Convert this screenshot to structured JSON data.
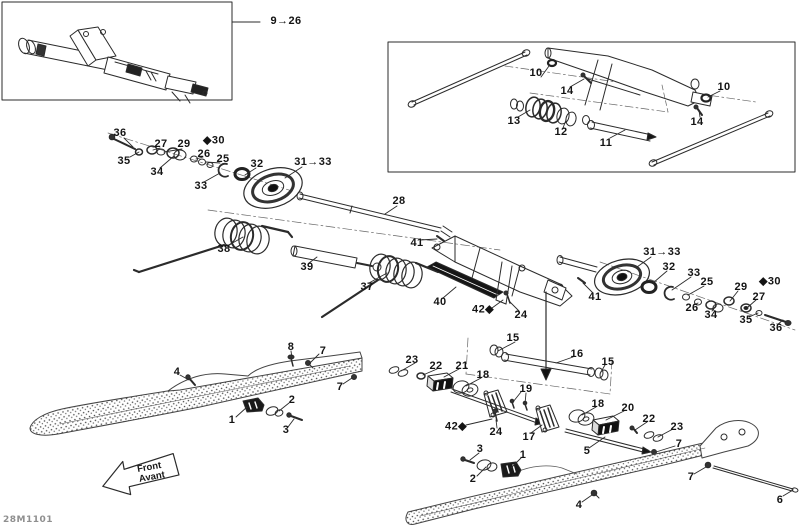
{
  "doc": {
    "part_code": "28M1101"
  },
  "front_arrow": {
    "line1": "Front",
    "line2": "Avant"
  },
  "colors": {
    "line": "#2b2b2b",
    "label": "#141414",
    "muted": "#8f8f8f",
    "dark_fill": "#161616"
  },
  "callouts": [
    {
      "t": "9→26",
      "x": 286,
      "y": 21
    },
    {
      "t": "10",
      "x": 536,
      "y": 73
    },
    {
      "t": "14",
      "x": 567,
      "y": 91
    },
    {
      "t": "13",
      "x": 514,
      "y": 121
    },
    {
      "t": "12",
      "x": 561,
      "y": 132
    },
    {
      "t": "11",
      "x": 606,
      "y": 143
    },
    {
      "t": "10",
      "x": 724,
      "y": 87
    },
    {
      "t": "14",
      "x": 697,
      "y": 122
    },
    {
      "t": "36",
      "x": 120,
      "y": 133
    },
    {
      "t": "35",
      "x": 124,
      "y": 161
    },
    {
      "t": "27",
      "x": 161,
      "y": 144
    },
    {
      "t": "29",
      "x": 184,
      "y": 144
    },
    {
      "t": "◆30",
      "x": 214,
      "y": 140
    },
    {
      "t": "34",
      "x": 157,
      "y": 172
    },
    {
      "t": "26",
      "x": 204,
      "y": 154
    },
    {
      "t": "25",
      "x": 223,
      "y": 159
    },
    {
      "t": "33",
      "x": 201,
      "y": 186
    },
    {
      "t": "32",
      "x": 257,
      "y": 164
    },
    {
      "t": "31→33",
      "x": 313,
      "y": 162
    },
    {
      "t": "28",
      "x": 399,
      "y": 201
    },
    {
      "t": "38",
      "x": 224,
      "y": 249
    },
    {
      "t": "39",
      "x": 307,
      "y": 267
    },
    {
      "t": "37",
      "x": 367,
      "y": 287
    },
    {
      "t": "41",
      "x": 417,
      "y": 243
    },
    {
      "t": "40",
      "x": 440,
      "y": 302
    },
    {
      "t": "42◆",
      "x": 483,
      "y": 309
    },
    {
      "t": "24",
      "x": 521,
      "y": 315
    },
    {
      "t": "41",
      "x": 595,
      "y": 297
    },
    {
      "t": "31→33",
      "x": 662,
      "y": 252
    },
    {
      "t": "32",
      "x": 669,
      "y": 267
    },
    {
      "t": "33",
      "x": 694,
      "y": 273
    },
    {
      "t": "25",
      "x": 707,
      "y": 282
    },
    {
      "t": "29",
      "x": 741,
      "y": 287
    },
    {
      "t": "◆30",
      "x": 770,
      "y": 281
    },
    {
      "t": "26",
      "x": 692,
      "y": 308
    },
    {
      "t": "34",
      "x": 711,
      "y": 315
    },
    {
      "t": "27",
      "x": 759,
      "y": 297
    },
    {
      "t": "35",
      "x": 746,
      "y": 320
    },
    {
      "t": "36",
      "x": 776,
      "y": 328
    },
    {
      "t": "15",
      "x": 513,
      "y": 338
    },
    {
      "t": "16",
      "x": 577,
      "y": 354
    },
    {
      "t": "15",
      "x": 608,
      "y": 362
    },
    {
      "t": "23",
      "x": 412,
      "y": 360
    },
    {
      "t": "22",
      "x": 436,
      "y": 366
    },
    {
      "t": "21",
      "x": 462,
      "y": 366
    },
    {
      "t": "18",
      "x": 483,
      "y": 375
    },
    {
      "t": "19",
      "x": 526,
      "y": 389
    },
    {
      "t": "42◆",
      "x": 456,
      "y": 426
    },
    {
      "t": "24",
      "x": 496,
      "y": 432
    },
    {
      "t": "17",
      "x": 529,
      "y": 437
    },
    {
      "t": "18",
      "x": 598,
      "y": 404
    },
    {
      "t": "20",
      "x": 628,
      "y": 408
    },
    {
      "t": "22",
      "x": 649,
      "y": 419
    },
    {
      "t": "23",
      "x": 677,
      "y": 427
    },
    {
      "t": "3",
      "x": 480,
      "y": 449
    },
    {
      "t": "2",
      "x": 473,
      "y": 479
    },
    {
      "t": "1",
      "x": 523,
      "y": 455
    },
    {
      "t": "5",
      "x": 587,
      "y": 451
    },
    {
      "t": "7",
      "x": 679,
      "y": 444
    },
    {
      "t": "7",
      "x": 691,
      "y": 477
    },
    {
      "t": "6",
      "x": 780,
      "y": 500
    },
    {
      "t": "4",
      "x": 579,
      "y": 505
    },
    {
      "t": "8",
      "x": 291,
      "y": 347
    },
    {
      "t": "7",
      "x": 323,
      "y": 351
    },
    {
      "t": "7",
      "x": 340,
      "y": 387
    },
    {
      "t": "4",
      "x": 177,
      "y": 372
    },
    {
      "t": "1",
      "x": 232,
      "y": 420
    },
    {
      "t": "2",
      "x": 292,
      "y": 400
    },
    {
      "t": "3",
      "x": 286,
      "y": 430
    }
  ]
}
